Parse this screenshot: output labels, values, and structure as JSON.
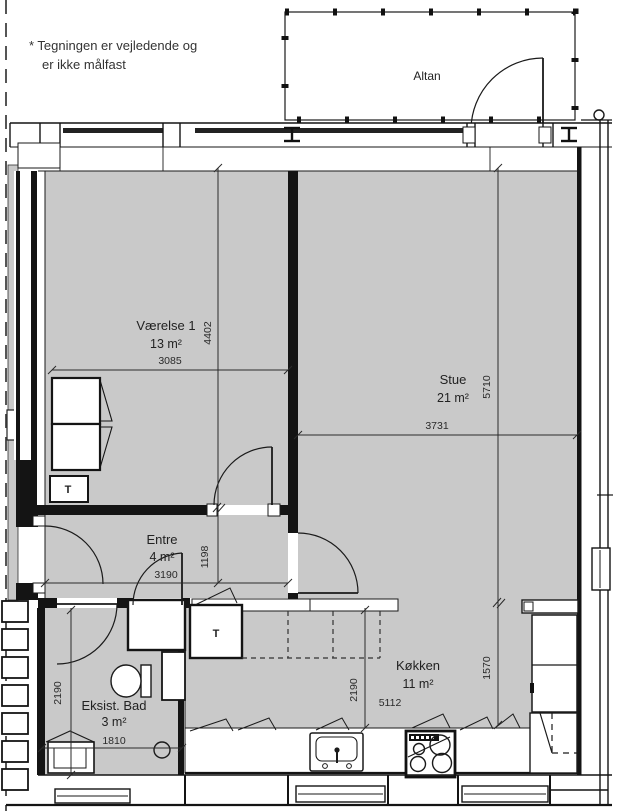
{
  "note": {
    "line1": "* Tegningen er vejledende og",
    "line2": "er ikke målfast"
  },
  "balcony": {
    "label": "Altan"
  },
  "rooms": [
    {
      "id": "vaerelse-1",
      "name": "Værelse 1",
      "area": "13 m²"
    },
    {
      "id": "stue",
      "name": "Stue",
      "area": "21 m²"
    },
    {
      "id": "entre",
      "name": "Entre",
      "area": "4 m²"
    },
    {
      "id": "koekken",
      "name": "Køkken",
      "area": "11 m²"
    },
    {
      "id": "eksist-bad",
      "name": "Eksist. Bad",
      "area": "3 m²"
    }
  ],
  "dimensions_mm": {
    "vaerelse_width": "3085",
    "vaerelse_height": "4402",
    "entre_width": "3190",
    "entre_height": "1198",
    "stue_width": "3731",
    "stue_height": "5710",
    "koekken_depth": "1570",
    "koekken_clearance": "2190",
    "koekken_width": "5112",
    "bad_depth": "2190",
    "bad_width": "1810"
  },
  "symbols": {
    "shaft_label": "T"
  },
  "colors": {
    "room_fill": "#c9c9c9",
    "wall": "#141414",
    "line": "#1a1a1a"
  }
}
